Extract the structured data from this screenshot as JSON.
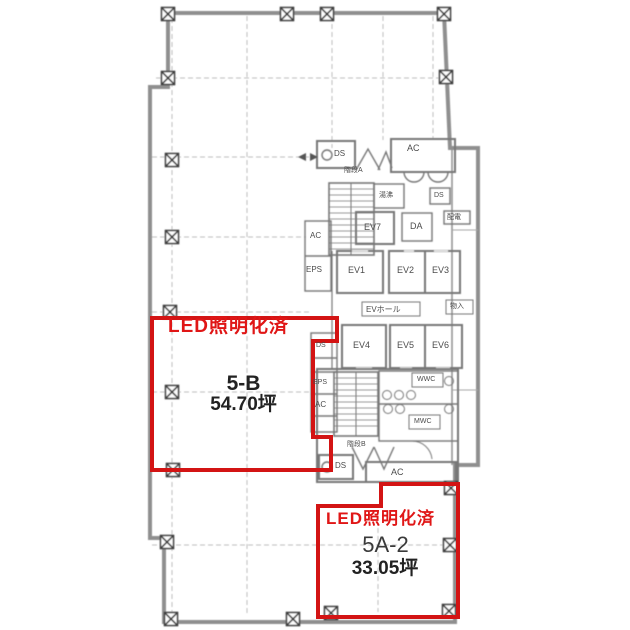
{
  "plan": {
    "units": [
      {
        "id": "5-B",
        "led_label": "LED照明化済",
        "name": "5-B",
        "area": "54.70坪"
      },
      {
        "id": "5A-2",
        "led_label": "LED照明化済",
        "name": "5A-2",
        "area": "33.05坪"
      }
    ],
    "elevators": [
      "EV1",
      "EV2",
      "EV3",
      "EV4",
      "EV5",
      "EV6",
      "EV7"
    ],
    "labels": {
      "ev_hall": "EVホール",
      "ac": "AC",
      "ds": "DS",
      "eps": "EPS",
      "da": "DA",
      "stair_a": "階段A",
      "stair_b": "階段B",
      "kitchenette": "湯沸",
      "elec": "配電",
      "storage": "物入",
      "wwc": "WWC",
      "mwc": "MWC"
    },
    "colors": {
      "highlight_red": "#d31414",
      "led_text_red": "#e01616",
      "wall_gray": "#8f8f8f",
      "text_gray": "#4c4c4c"
    }
  }
}
